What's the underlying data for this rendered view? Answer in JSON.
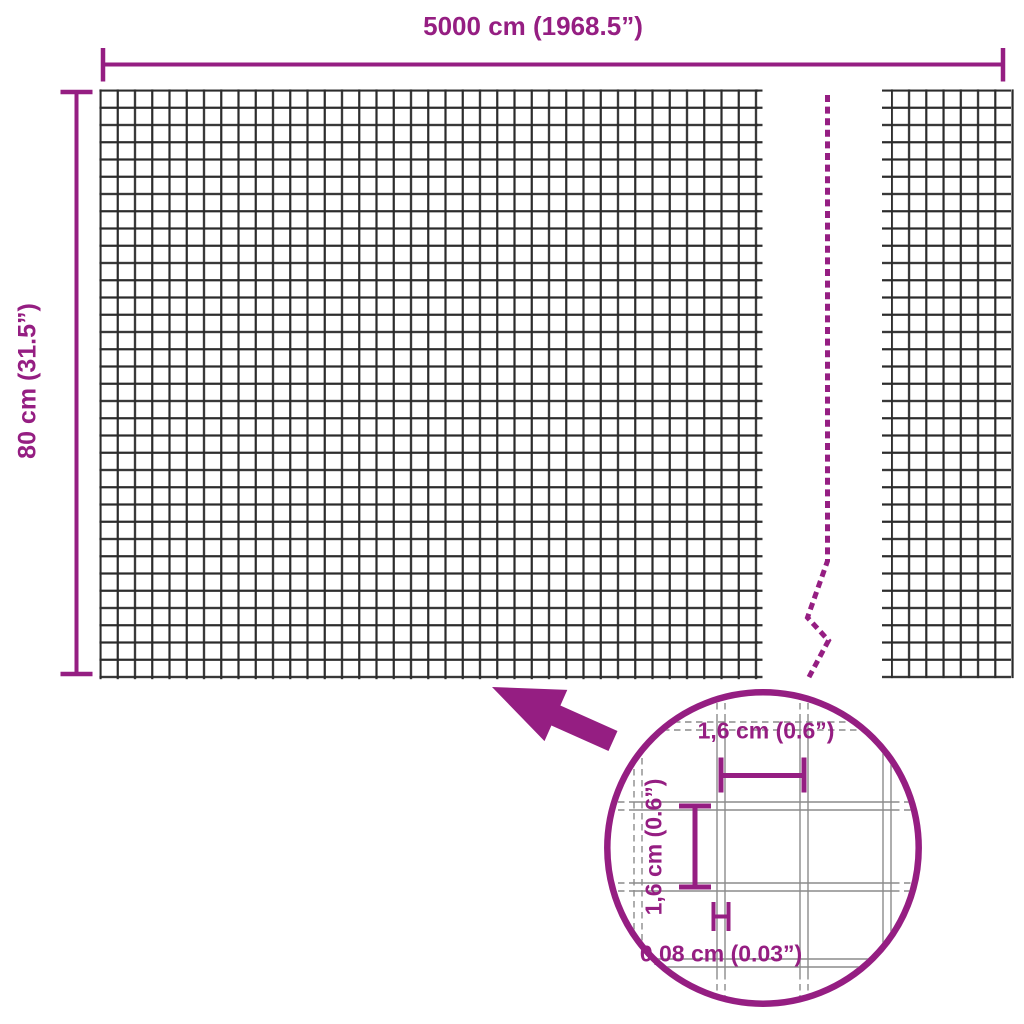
{
  "diagram": {
    "product": "wire-mesh-fence-dimension-diagram",
    "overall_width_label": "5000 cm (1968.5”)",
    "overall_height_label": "80 cm (31.5”)",
    "detail": {
      "cell_width_label": "1,6 cm (0.6”)",
      "cell_height_label": "1,6 cm (0.6”)",
      "wire_thickness_label": "0,08 cm (0.03”)"
    },
    "colors": {
      "accent": "#951E82",
      "mesh": "#2B2B2B",
      "detail_mesh": "#8C8C8C",
      "background": "#FFFFFF"
    }
  }
}
